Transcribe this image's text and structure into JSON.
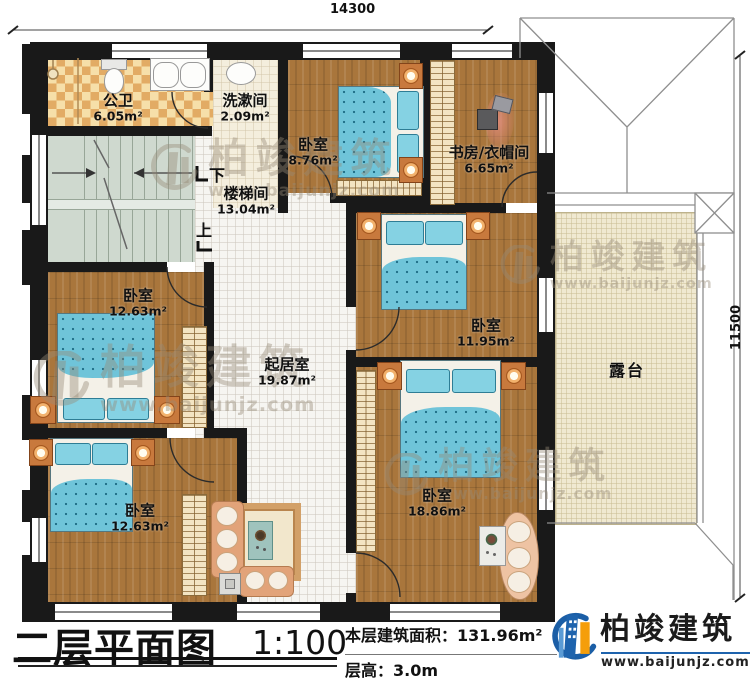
{
  "dimensions": {
    "width_top": "14300",
    "height_right": "11500"
  },
  "rooms": {
    "bath": {
      "label": "公卫",
      "area": "6.05m²"
    },
    "wash": {
      "label": "洗漱间",
      "area": "2.09m²"
    },
    "bedroom_top": {
      "label": "卧室",
      "area": "8.76m²"
    },
    "study": {
      "label": "书房/衣帽间",
      "area": "6.65m²"
    },
    "stairhall": {
      "label": "楼梯间",
      "area": "13.04m²"
    },
    "bedroom_mid_left": {
      "label": "卧室",
      "area": "12.63m²"
    },
    "living": {
      "label": "起居室",
      "area": "19.87m²"
    },
    "bedroom_right": {
      "label": "卧室",
      "area": "11.95m²"
    },
    "bedroom_bottom_left": {
      "label": "卧室",
      "area": "12.63m²"
    },
    "bedroom_big": {
      "label": "卧室",
      "area": "18.86m²"
    },
    "terrace": {
      "label": "露台"
    }
  },
  "stairs": {
    "down": "下",
    "up": "上"
  },
  "titleblock": {
    "title": "二层平面图",
    "scale": "1:100",
    "area_label": "本层建筑面积：",
    "area_value": "131.96m²",
    "floor_height_label": "层高：",
    "floor_height_value": "3.0m"
  },
  "brand": {
    "name": "柏竣建筑",
    "url": "www.baijunjz.com"
  },
  "watermark": {
    "name": "柏竣建筑",
    "url": "www.baijunjz.com"
  },
  "colors": {
    "wall": "#191919",
    "wood_floor": "#a9763c",
    "terrace_floor": "#f0e9d1",
    "bed_blue": "#6fc4d9",
    "brand_blue": "#1b5ea6",
    "brand_orange": "#f59e0b"
  }
}
